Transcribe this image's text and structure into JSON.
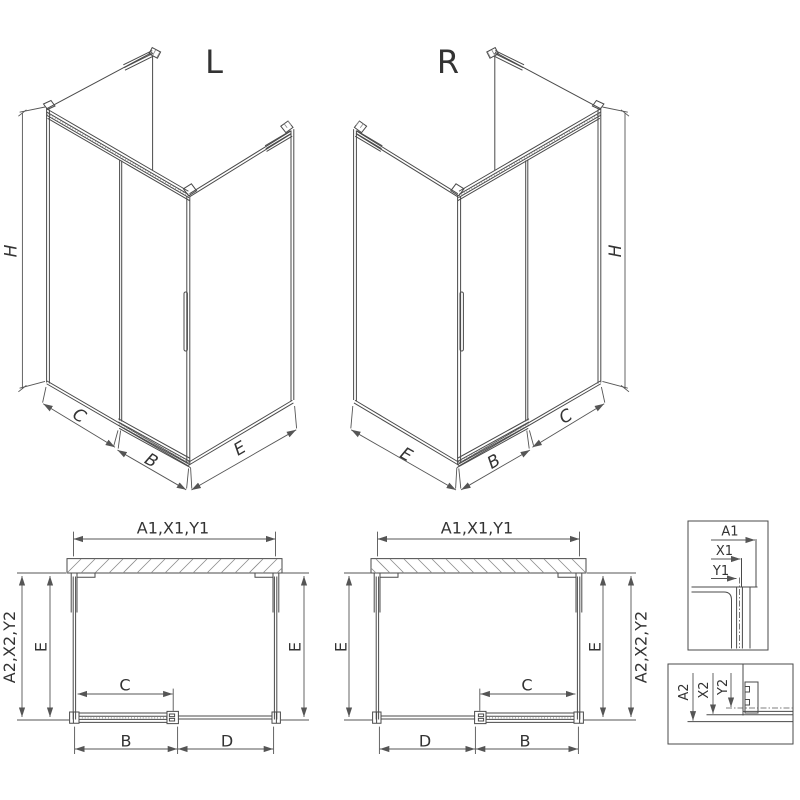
{
  "colors": {
    "background": "#ffffff",
    "line": "#4a4a4a",
    "dimension_line": "#555555",
    "text": "#333333",
    "hatch": "#8a8a8a"
  },
  "drawing": {
    "iso_left": {
      "title": "L",
      "height": "H",
      "panel_c": "C",
      "panel_b": "B",
      "panel_e": "E"
    },
    "iso_right": {
      "title": "R",
      "height": "H",
      "panel_c": "C",
      "panel_b": "B",
      "panel_e": "E"
    },
    "plan_left": {
      "width_top": "A1,X1,Y1",
      "depth_side": "A2,X2,Y2",
      "e_left": "E",
      "e_right": "E",
      "c": "C",
      "b": "B",
      "d": "D"
    },
    "plan_right": {
      "width_top": "A1,X1,Y1",
      "depth_side": "A2,X2,Y2",
      "e_left": "E",
      "e_right": "E",
      "c": "C",
      "b": "B",
      "d": "D"
    },
    "detail_a1": {
      "a": "A1",
      "x": "X1",
      "y": "Y1"
    },
    "detail_a2": {
      "a": "A2",
      "x": "X2",
      "y": "Y2"
    }
  }
}
